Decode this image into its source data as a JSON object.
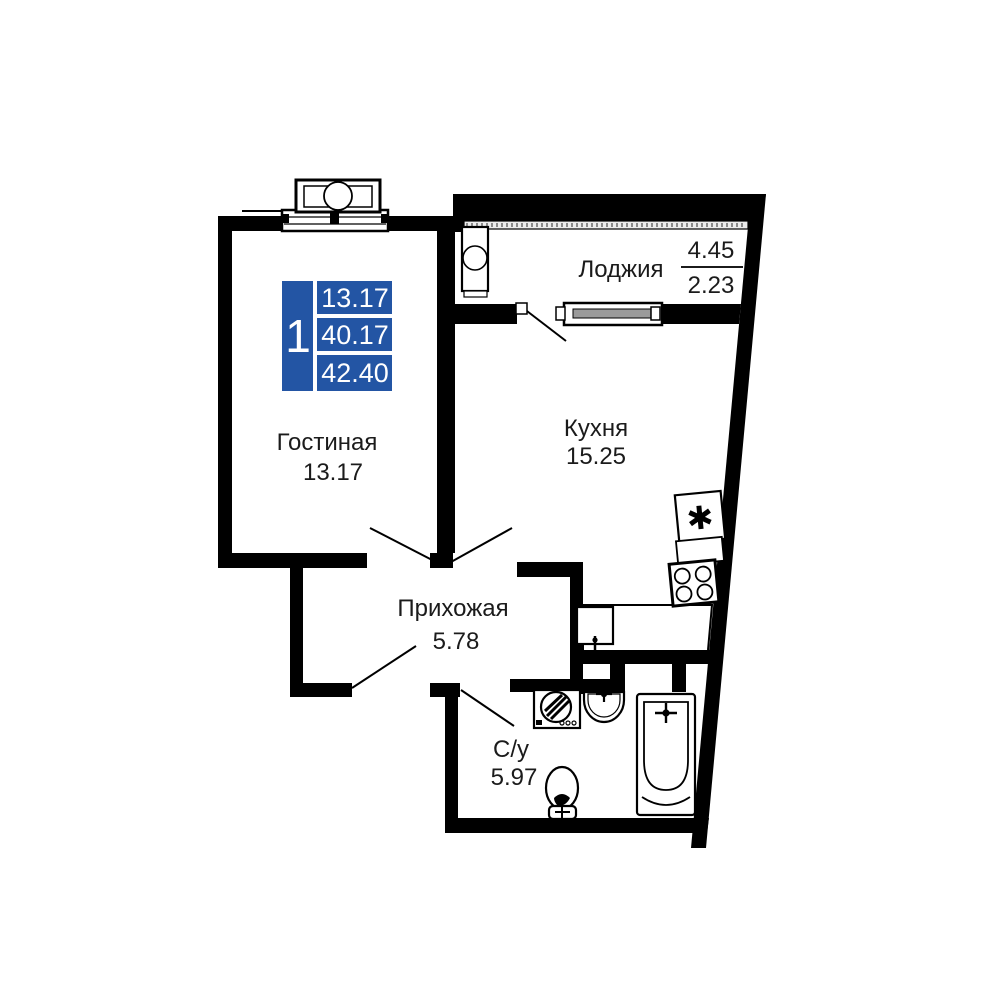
{
  "legend": {
    "rooms_count": "1",
    "areas": [
      "13.17",
      "40.17",
      "42.40"
    ]
  },
  "rooms": {
    "loggia": {
      "label": "Лоджия",
      "area_full": "4.45",
      "area_counted": "2.23"
    },
    "kitchen": {
      "label": "Кухня",
      "area": "15.25"
    },
    "living_room": {
      "label": "Гостиная",
      "area": "13.17"
    },
    "hallway": {
      "label": "Прихожая",
      "area": "5.78"
    },
    "bathroom": {
      "label": "С/у",
      "area": "5.97"
    }
  },
  "icons": {
    "fridge_glyph": "✱"
  },
  "colors": {
    "wall": "#000000",
    "legend_background": "#2355a4",
    "legend_text": "#ffffff",
    "label_text": "#1b1b1b"
  }
}
